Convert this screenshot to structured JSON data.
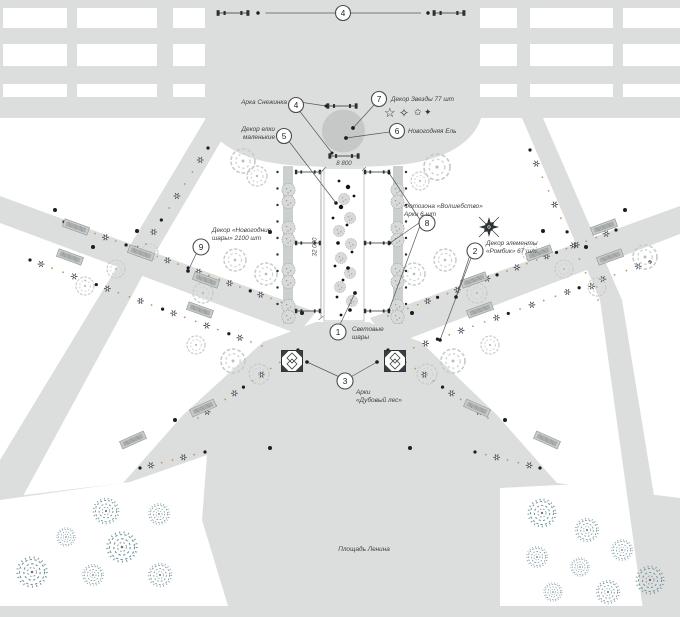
{
  "plan": {
    "square_label": "Площадь Ленина",
    "dim_width": "8 800",
    "dim_height": "32 000"
  },
  "callouts": {
    "c1": {
      "num": "1",
      "line1": "Световые",
      "line2": "шары"
    },
    "c2": {
      "num": "2",
      "line1": "Декор элементы",
      "line2": "«Ромбик» 67 шт"
    },
    "c3": {
      "num": "3",
      "line1": "Арки",
      "line2": "«Дубовый лес»"
    },
    "c4": {
      "num": "4",
      "label": "Арка Снежинка"
    },
    "c4_top": {
      "num": "4"
    },
    "c5": {
      "num": "5",
      "line1": "Декор елки",
      "line2": "маленькие"
    },
    "c6": {
      "num": "6",
      "label": "Новогодняя Ель"
    },
    "c7": {
      "num": "7",
      "label": "Декор Звезды 77 шт"
    },
    "c8": {
      "num": "8",
      "line1": "Фотозона «Волшебство»",
      "line2": "Арки 6 шт"
    },
    "c9": {
      "num": "9",
      "line1": "Декор «Новогодние",
      "line2": "шары» 2100 шт"
    }
  },
  "icons": {
    "star_outline": "☆",
    "sparkle_outline": "✧",
    "star_small": "✩",
    "sparkle_small": "✦"
  },
  "colors": {
    "paving": "#dcdedd",
    "tree_crown": "#c5c8c7",
    "garland_dot": "#c2974f",
    "park_tree": "#5e8b94",
    "ink": "#3c3f41"
  }
}
